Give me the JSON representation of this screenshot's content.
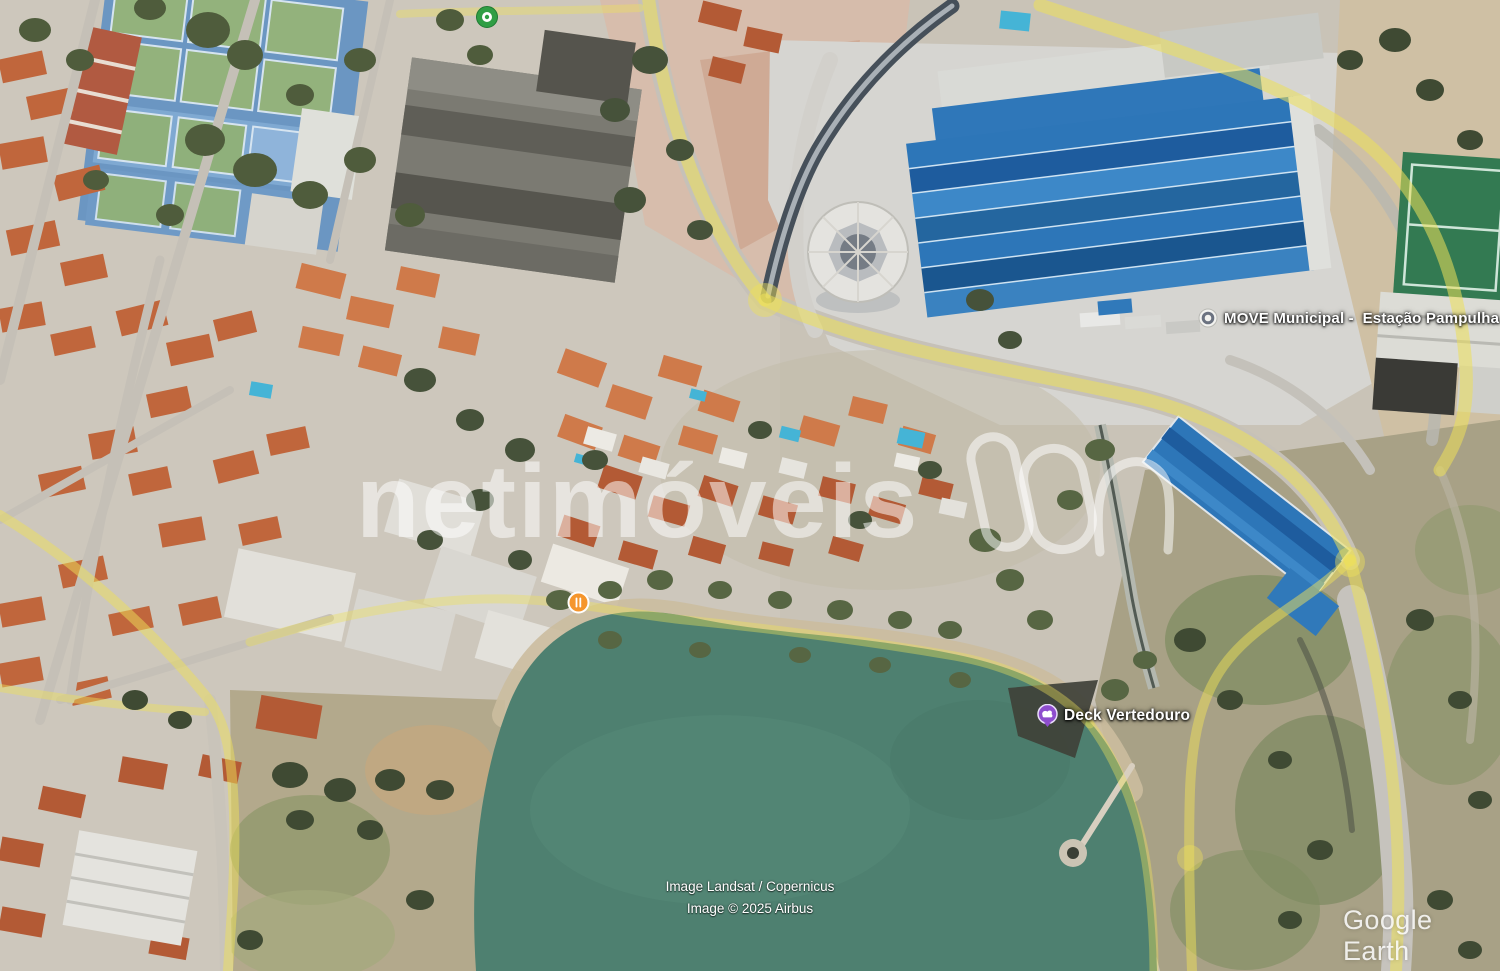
{
  "app": {
    "brand_logo_text": "Google Earth"
  },
  "watermark": {
    "text": "netimóveis",
    "logo": "netimoveis-monogram-outline"
  },
  "map_labels": {
    "station": {
      "text": "MOVE Municipal -  Estação Pampulha",
      "icon": "transit-station-marker"
    },
    "deck": {
      "text": "Deck Vertedouro",
      "icon": "photo-spot-marker"
    }
  },
  "markers": {
    "park_poi": {
      "icon": "green-dot-marker"
    },
    "restaurant_poi": {
      "icon": "restaurant-marker"
    }
  },
  "attribution": {
    "line1": "Image Landsat / Copernicus",
    "line2": "Image © 2025 Airbus"
  },
  "colors": {
    "lake_water": "#4e8070",
    "road_highlight": "#ede05a",
    "station_roof_blue": "#2d76b8",
    "watermark_white": "rgba(255,255,255,0.52)",
    "label_text": "#ffffff",
    "marker_green": "#2f9e44",
    "marker_orange": "#f5962d",
    "marker_purple": "#8e4dce",
    "attribution_text": "#ffffff",
    "google_earth_logo": "rgba(255,255,255,0.85)"
  }
}
